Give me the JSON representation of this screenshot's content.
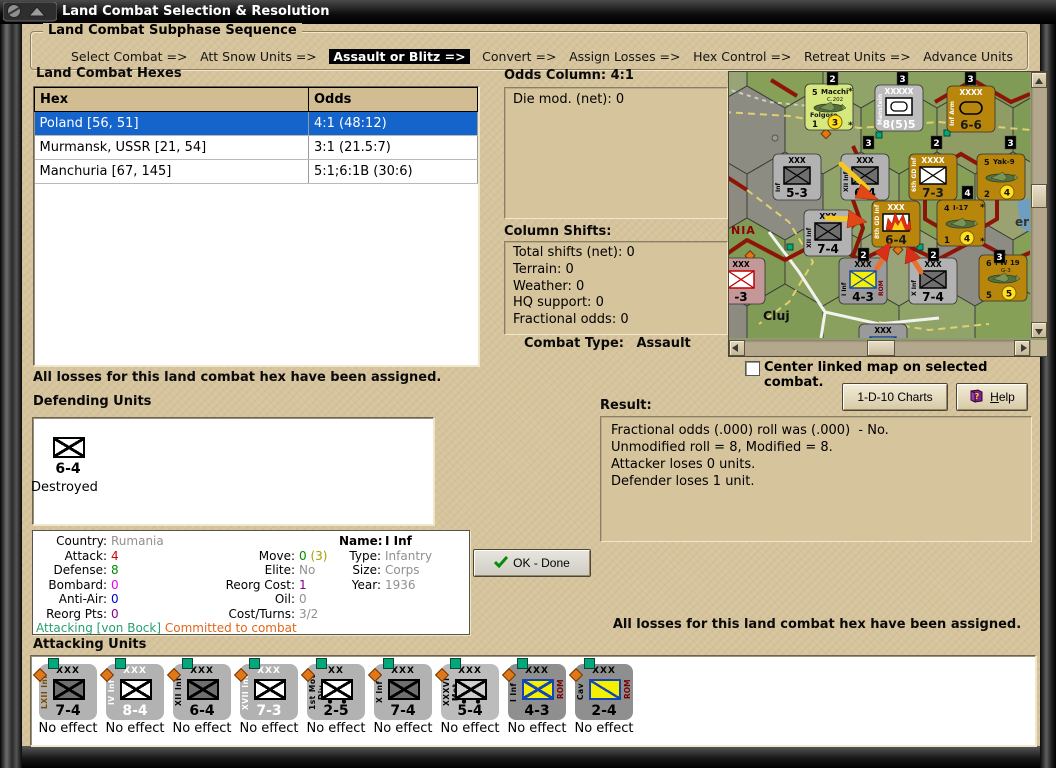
{
  "window": {
    "title": "Land Combat Selection & Resolution"
  },
  "sequence": {
    "title": "Land Combat Subphase Sequence",
    "steps": [
      "Select Combat =>",
      "Att Snow Units =>",
      "Assault or Blitz =>",
      "Convert =>",
      "Assign Losses =>",
      "Hex Control =>",
      "Retreat Units =>",
      "Advance Units"
    ],
    "active_index": 2
  },
  "hexes": {
    "title": "Land Combat Hexes",
    "columns": [
      "Hex",
      "Odds"
    ],
    "rows": [
      {
        "hex": "Poland [56, 51]",
        "odds": "4:1 (48:12)",
        "selected": true
      },
      {
        "hex": "Murmansk, USSR [21, 54]",
        "odds": "3:1 (21.5:7)",
        "selected": false
      },
      {
        "hex": "Manchuria [67, 145]",
        "odds": "5:1;6:1B (30:6)",
        "selected": false
      }
    ]
  },
  "odds_panel": {
    "title": "Odds Column: 4:1",
    "die_mod": "Die mod. (net): 0"
  },
  "shifts_panel": {
    "title": "Column Shifts:",
    "lines": [
      "Total shifts (net): 0",
      "Terrain: 0",
      "Weather: 0",
      "HQ support: 0",
      "Fractional odds: 0"
    ]
  },
  "combat_type": {
    "label": "Combat Type:",
    "value": "Assault"
  },
  "checkbox": {
    "label": "Center linked map on selected combat.",
    "checked": false
  },
  "buttons": {
    "charts": "1-D-10 Charts",
    "help": "Help",
    "ok": "OK - Done"
  },
  "messages": {
    "left": "All losses for this land combat hex have been assigned.",
    "right": "All losses for this land combat hex have been assigned."
  },
  "defending": {
    "title": "Defending Units",
    "unit": {
      "size": "XXXX",
      "name": "8th GD Inf",
      "strength": "6-4",
      "status": "Destroyed",
      "color": "#b8860b"
    }
  },
  "unit_info": {
    "rows": [
      [
        {
          "label": "Country:",
          "parts": [
            {
              "text": "Rumania",
              "color": "#909090"
            }
          ]
        },
        null,
        {
          "label": "Name:",
          "parts": [
            {
              "text": "I Inf",
              "color": "#000000"
            }
          ],
          "bold": true
        }
      ],
      [
        {
          "label": "Attack:",
          "parts": [
            {
              "text": "4",
              "color": "#d00000"
            }
          ]
        },
        {
          "label": "Move:",
          "parts": [
            {
              "text": "0",
              "color": "#008800"
            },
            {
              "text": " (3)",
              "color": "#a0a000"
            }
          ]
        },
        {
          "label": "Type:",
          "parts": [
            {
              "text": "Infantry",
              "color": "#909090"
            }
          ]
        }
      ],
      [
        {
          "label": "Defense:",
          "parts": [
            {
              "text": "8",
              "color": "#008800"
            }
          ]
        },
        {
          "label": "Elite:",
          "parts": [
            {
              "text": "No",
              "color": "#909090"
            }
          ]
        },
        {
          "label": "Size:",
          "parts": [
            {
              "text": "Corps",
              "color": "#909090"
            }
          ]
        }
      ],
      [
        {
          "label": "Bombard:",
          "parts": [
            {
              "text": "0",
              "color": "#e800e8"
            }
          ]
        },
        {
          "label": "Reorg Cost:",
          "parts": [
            {
              "text": "1",
              "color": "#880088"
            }
          ]
        },
        {
          "label": "Year:",
          "parts": [
            {
              "text": "1936",
              "color": "#909090"
            }
          ]
        }
      ],
      [
        {
          "label": "Anti-Air:",
          "parts": [
            {
              "text": "0",
              "color": "#0000d0"
            }
          ]
        },
        {
          "label": "Oil:",
          "parts": [
            {
              "text": "0",
              "color": "#909090"
            }
          ]
        },
        null
      ],
      [
        {
          "label": "Reorg Pts:",
          "parts": [
            {
              "text": "0",
              "color": "#880088"
            }
          ]
        },
        {
          "label": "Cost/Turns:",
          "parts": [
            {
              "text": "3/2",
              "color": "#909090"
            }
          ]
        },
        null
      ]
    ],
    "footer": [
      {
        "text": "Attacking [von Bock]",
        "color": "#28a06e"
      },
      {
        "text": " Committed to combat",
        "color": "#e2661a"
      }
    ]
  },
  "result": {
    "title": "Result:",
    "lines": [
      "Fractional odds (.000) roll was (.000)  - No.",
      "Unmodified roll = 8, Modified = 8.",
      "Attacker loses 0 units.",
      "Defender loses 1 unit."
    ]
  },
  "attacking": {
    "title": "Attacking Units",
    "units": [
      {
        "size": "XXX",
        "name": "LXII Inf",
        "strength": "7-4",
        "status": "No effect",
        "bg": "#b2b2b2",
        "text": "#000000",
        "name_color": "#7a4a00",
        "symbol": "inf-dark"
      },
      {
        "size": "XXX",
        "name": "IV Inf",
        "strength": "8-4",
        "status": "No effect",
        "bg": "#b2b2b2",
        "text": "#ffffff",
        "name_color": "#ffffff",
        "symbol": "inf-white"
      },
      {
        "size": "XXX",
        "name": "XII Inf",
        "strength": "6-4",
        "status": "No effect",
        "bg": "#b2b2b2",
        "text": "#000000",
        "name_color": "#000000",
        "symbol": "inf-dark"
      },
      {
        "size": "XXX",
        "name": "XVII Inf",
        "strength": "7-3",
        "status": "No effect",
        "bg": "#b2b2b2",
        "text": "#ffffff",
        "name_color": "#ffffff",
        "symbol": "inf-white"
      },
      {
        "size": "XX",
        "name": "1st Mot Div",
        "strength": "2-5",
        "status": "No effect",
        "bg": "#b2b2b2",
        "text": "#000000",
        "name_color": "#000000",
        "symbol": "mot-white"
      },
      {
        "size": "XXX",
        "name": "X Inf",
        "strength": "7-4",
        "status": "No effect",
        "bg": "#b2b2b2",
        "text": "#000000",
        "name_color": "#000000",
        "symbol": "inf-dark"
      },
      {
        "size": "XXX",
        "name": "XXXVI Mot",
        "strength": "5-4",
        "status": "No effect",
        "bg": "#bcbcbc",
        "text": "#000000",
        "name_color": "#000000",
        "symbol": "mot-gray"
      },
      {
        "size": "XXX",
        "name": "I Inf",
        "side": "ROM",
        "strength": "4-3",
        "status": "No effect",
        "bg": "#8f8f8f",
        "text": "#000000",
        "name_color": "#000000",
        "symbol": "yellow-x"
      },
      {
        "size": "XXX",
        "name": "Cav",
        "side": "ROM",
        "strength": "2-4",
        "status": "No effect",
        "bg": "#8f8f8f",
        "text": "#000000",
        "name_color": "#000000",
        "symbol": "yellow-diag"
      }
    ]
  },
  "map": {
    "region_label": "NIA",
    "city_label": "Cluj",
    "edge_label": "erm",
    "badges": [
      "2",
      "3",
      "3",
      "3",
      "2",
      "3",
      "4",
      "2",
      "2",
      "3"
    ],
    "counters": [
      {
        "kind": "air",
        "bg": "#d6e87e",
        "num": "5",
        "name": "Macchi",
        "sub": "C.202",
        "name2": "Folgore",
        "bl": "1",
        "circ": "3",
        "star": "*"
      },
      {
        "kind": "hq",
        "bg": "#bdbdbd",
        "size": "XXXXX",
        "name": "Manstein",
        "strength": "8(5)5"
      },
      {
        "kind": "armor",
        "bg": "#b8860b",
        "size": "XXXX",
        "name": "Inf Arm",
        "strength": "6-6"
      },
      {
        "kind": "inf",
        "theme": "gray",
        "size": "XXX",
        "name": "Inf",
        "strength": "5-3"
      },
      {
        "kind": "inf",
        "theme": "gray",
        "size": "XXX",
        "name": "XII Inf",
        "strength": "6-4"
      },
      {
        "kind": "inf",
        "theme": "brown",
        "size": "XXXX",
        "name": "6th GD Inf",
        "strength": "7-3"
      },
      {
        "kind": "air",
        "bg": "#b8860b",
        "num": "5",
        "name": "Yak-9",
        "bl": "2",
        "circ": "4"
      },
      {
        "kind": "inf",
        "theme": "gray",
        "size": "XXX",
        "name": "XII Inf",
        "strength": "7-4"
      },
      {
        "kind": "burn",
        "theme": "brown",
        "size": "XXX",
        "name": "8th GD Inf",
        "strength": "6-4"
      },
      {
        "kind": "air",
        "bg": "#b8860b",
        "num": "4",
        "name": "I-17",
        "bl": "1",
        "circ": "4",
        "star": "*"
      },
      {
        "kind": "inf",
        "theme": "pink",
        "size": "XXX",
        "name": "HUN",
        "strength": "-3"
      },
      {
        "kind": "inf",
        "theme": "rom",
        "size": "XXX",
        "name": "I Inf",
        "side": "ROM",
        "strength": "4-3"
      },
      {
        "kind": "inf",
        "theme": "gray",
        "size": "XXX",
        "name": "X Inf",
        "strength": "7-4"
      },
      {
        "kind": "air",
        "bg": "#b8860b",
        "num": "6",
        "name": "FW 19",
        "sub": "G-3",
        "bl": "5",
        "circ": "5"
      },
      {
        "kind": "inf",
        "theme": "rom",
        "size": "XXX",
        "name": "Mtn",
        "side": "ROM",
        "strength": ""
      }
    ]
  }
}
